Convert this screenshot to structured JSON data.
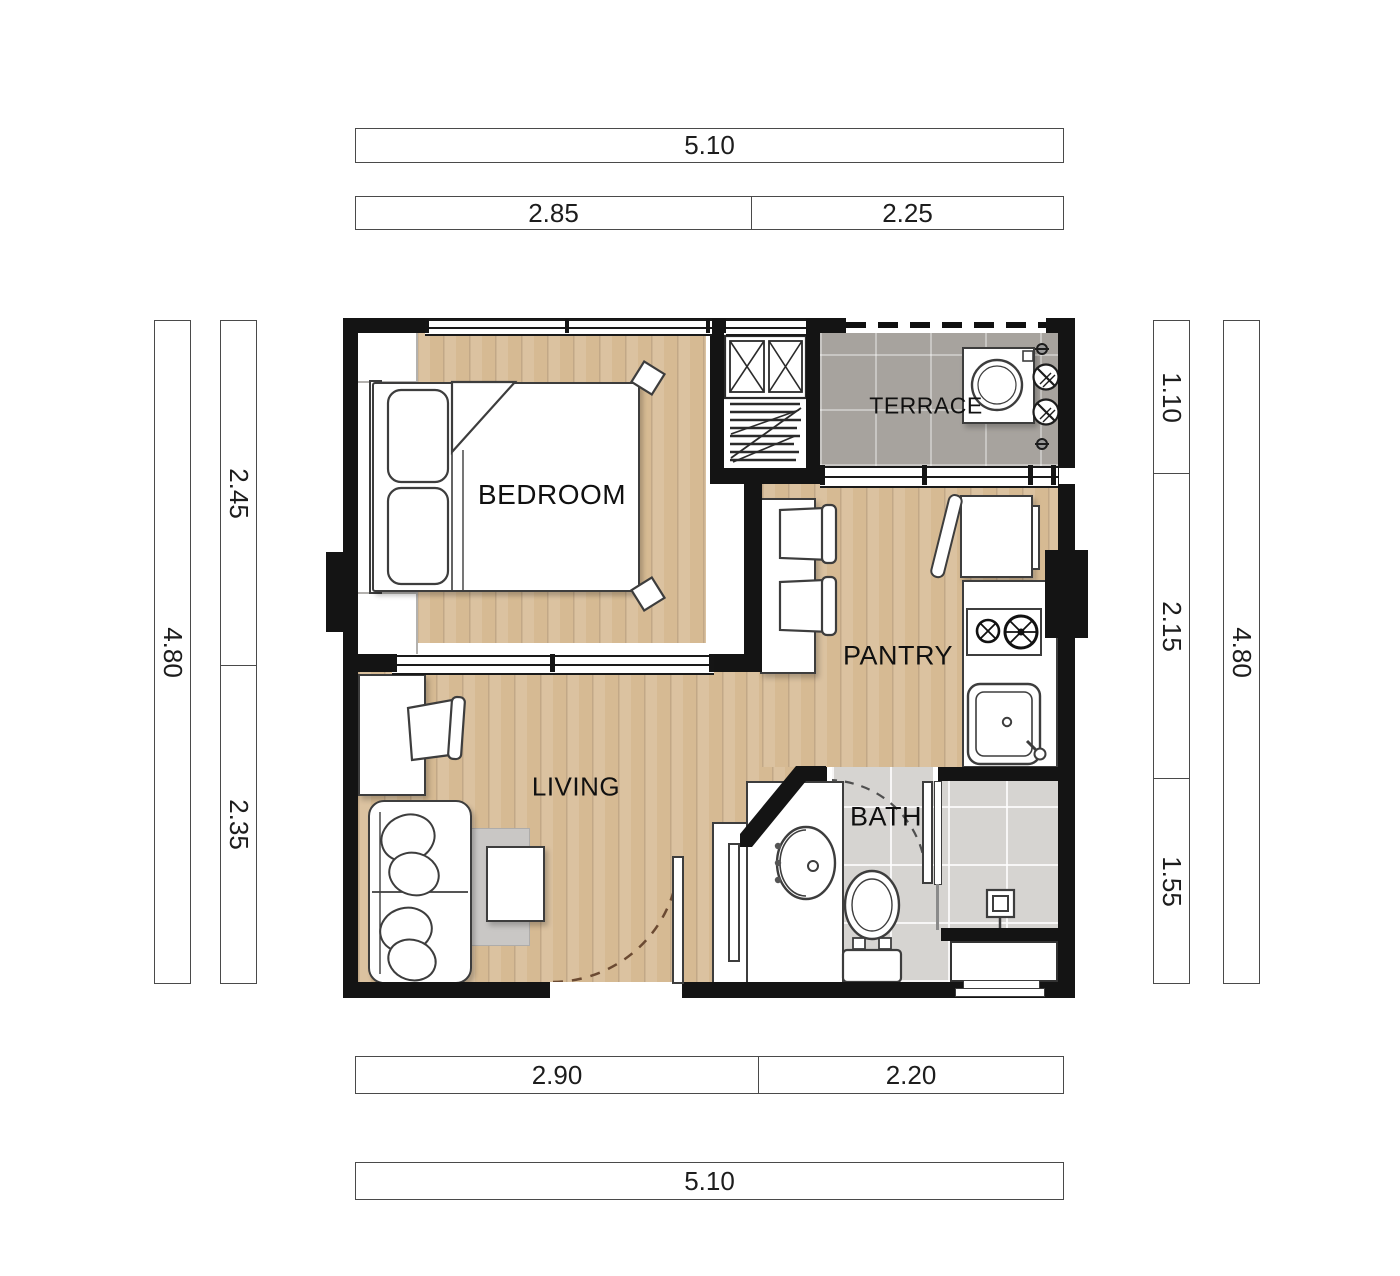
{
  "title": "One-bedroom apartment floor plan",
  "colors": {
    "wall": "#141414",
    "wood_floor": "#d6ba93",
    "terrace_floor": "#a7a39e",
    "bath_floor": "#d6d4d1",
    "furniture_fill": "#ffffff",
    "furniture_outline": "#3d3d3d",
    "rug": "#c9c7c5",
    "dimension_text": "#1d1d1d",
    "entry_door_arc": "#6b4a32",
    "bath_door_arc": "#4f4f4f"
  },
  "rooms": {
    "bedroom": {
      "label": "BEDROOM"
    },
    "terrace": {
      "label": "TERRACE"
    },
    "pantry": {
      "label": "PANTRY"
    },
    "living": {
      "label": "LIVING"
    },
    "bath": {
      "label": "BATH"
    }
  },
  "dimensions": {
    "top_overall": "5.10",
    "top_segments": [
      "2.85",
      "2.25"
    ],
    "bottom_segments": [
      "2.90",
      "2.20"
    ],
    "bottom_overall": "5.10",
    "left_overall": "4.80",
    "left_segments": [
      "2.45",
      "2.35"
    ],
    "right_segments": [
      "1.10",
      "2.15",
      "1.55"
    ],
    "right_overall": "4.80"
  }
}
